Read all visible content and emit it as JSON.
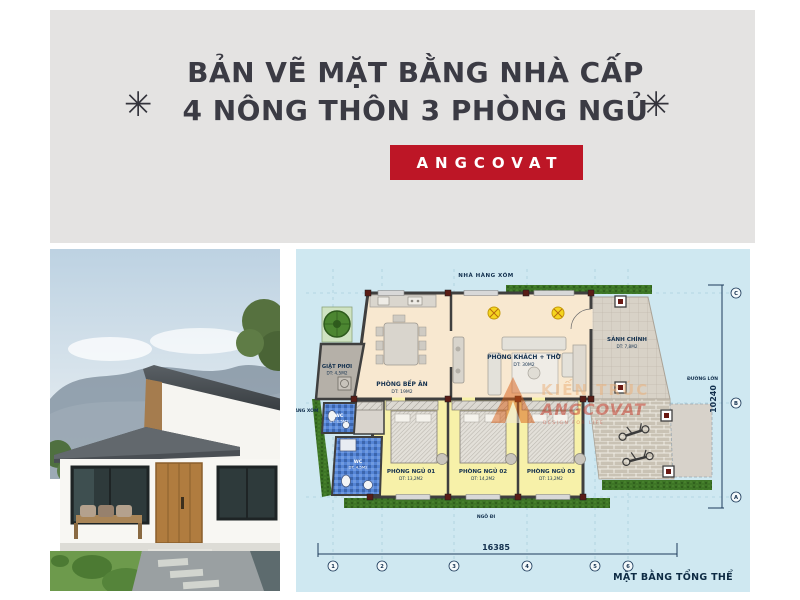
{
  "banner": {
    "decoration": "✳",
    "title_line1": "BẢN VẼ MẶT BẰNG NHÀ CẤP",
    "title_line2": "4 NÔNG THÔN 3 PHÒNG NGỦ",
    "brand": "ANGCOVAT",
    "colors": {
      "background": "#e4e3e2",
      "title": "#3b3b44",
      "brand_bg": "#bd1626",
      "brand_text": "#ffffff"
    }
  },
  "floor_plan": {
    "caption": "MẶT BẰNG TỔNG THỂ",
    "neighbor_top": "NHÀ HÀNG XÓM",
    "neighbor_left": "NHÀ HÀNG XÓM",
    "road_right": "ĐƯỜNG LỚN",
    "alley_bottom": "NGÕ ĐI",
    "dim_width": "16385",
    "dim_height": "10240",
    "grid_cols": [
      "1",
      "2",
      "3",
      "4",
      "5",
      "6"
    ],
    "grid_rows": [
      "C",
      "B",
      "A"
    ],
    "rooms": [
      {
        "name": "PHÒNG BẾP ĂN",
        "area": "DT: 19M2"
      },
      {
        "name": "PHÒNG KHÁCH + THỜ",
        "area": "DT: 30M2"
      },
      {
        "name": "GIẶT PHƠI",
        "area": "DT: 4,5M2"
      },
      {
        "name": "SẢNH CHÍNH",
        "area": "DT: 7,8M2"
      },
      {
        "name": "WC",
        "area": "DT: 1,5M2"
      },
      {
        "name": "WC",
        "area": "DT: 4,5M2"
      },
      {
        "name": "PHÒNG NGỦ 01",
        "area": "DT: 13,2M2"
      },
      {
        "name": "PHÒNG NGỦ 02",
        "area": "DT: 14,2M2"
      },
      {
        "name": "PHÒNG NGỦ 03",
        "area": "DT: 13,2M2"
      }
    ],
    "watermark": {
      "line1": "KIẾN TRÚC",
      "line2": "ANGCOVAT",
      "line3": "DESIGN FOR LIFE"
    },
    "colors": {
      "plan_bg": "#cfe8f1",
      "floor": "#f8e8d0",
      "bedroom": "#f7f1a9",
      "wc_tile": "#5585d6",
      "hedge": "#3d7526",
      "wall": "#3f3f3f",
      "label": "#13304e"
    }
  }
}
